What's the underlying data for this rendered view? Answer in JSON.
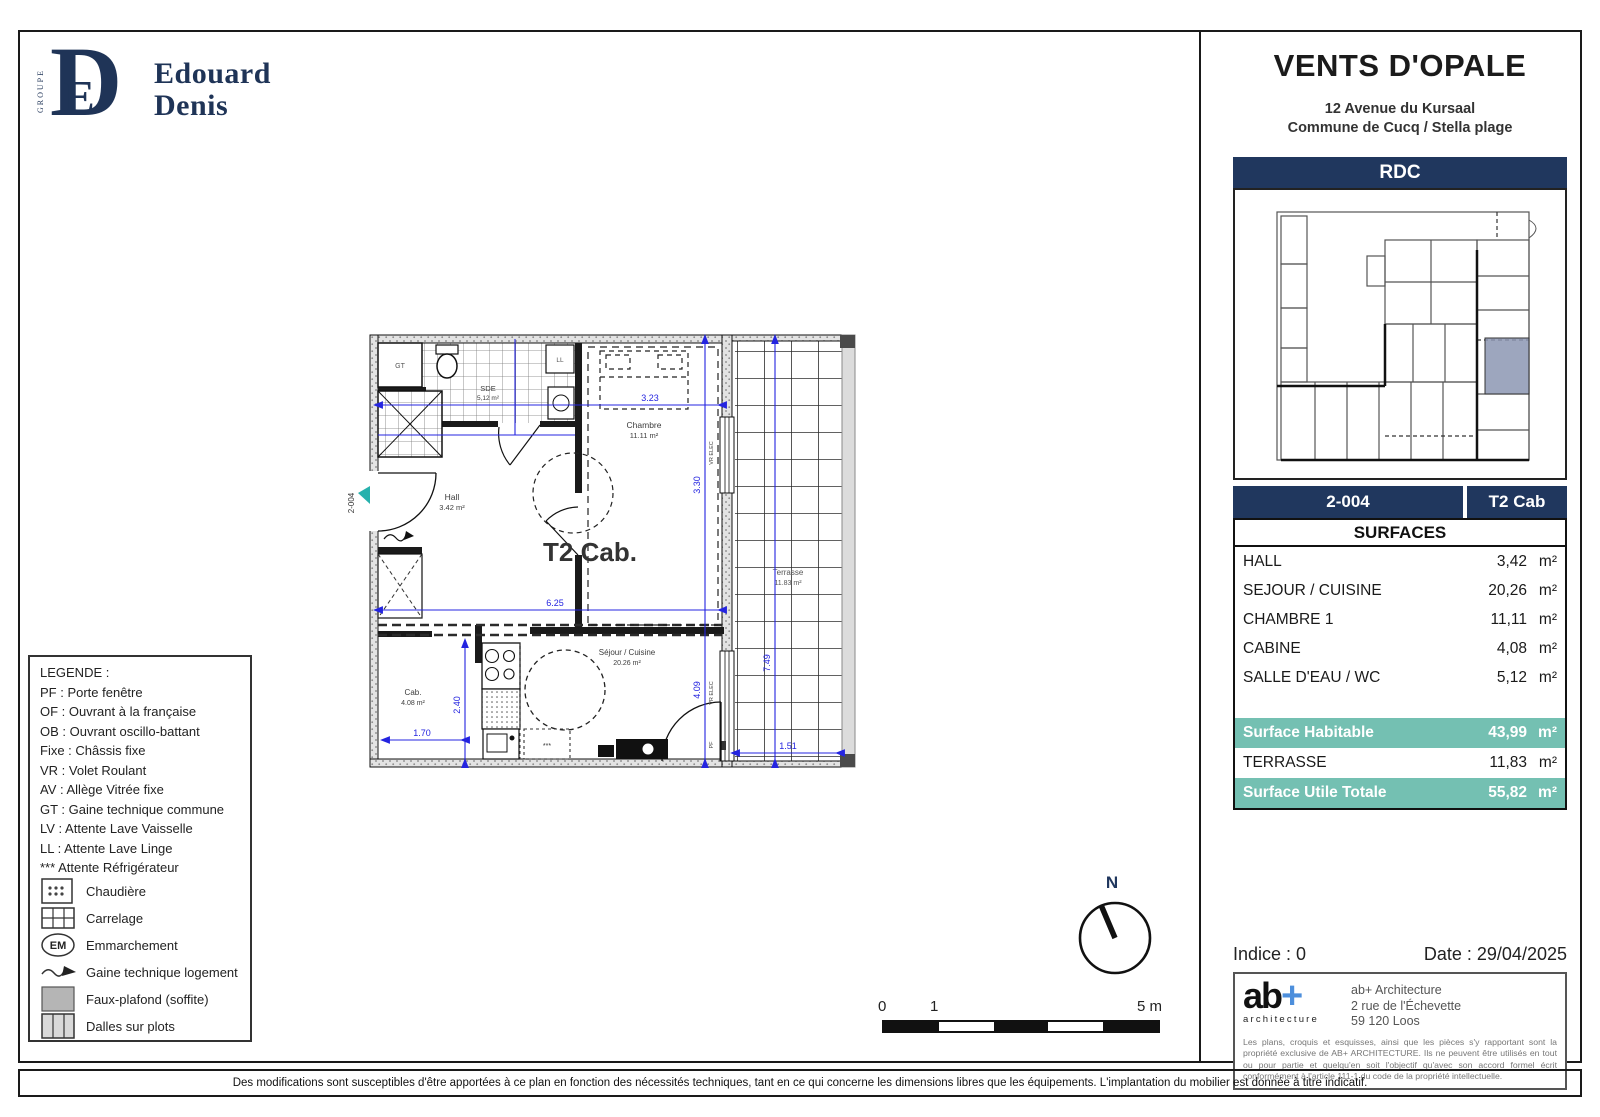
{
  "logo": {
    "groupe": "GROUPE",
    "monogram_d": "D",
    "monogram_e": "E",
    "name_line1": "Edouard",
    "name_line2": "Denis"
  },
  "header": {
    "title": "VENTS D'OPALE",
    "address_line1": "12 Avenue du Kursaal",
    "address_line2": "Commune de Cucq / Stella plage"
  },
  "panel": {
    "level_label": "RDC",
    "unit_number": "2-004",
    "unit_type": "T2 Cab",
    "surfaces_title": "SURFACES",
    "area_unit": "m²",
    "rooms": [
      {
        "label": "HALL",
        "value": "3,42"
      },
      {
        "label": "SEJOUR / CUISINE",
        "value": "20,26"
      },
      {
        "label": "CHAMBRE 1",
        "value": "11,11"
      },
      {
        "label": "CABINE",
        "value": "4,08"
      },
      {
        "label": "SALLE D'EAU / WC",
        "value": "5,12"
      }
    ],
    "totals": [
      {
        "label": "Surface Habitable",
        "value": "43,99"
      },
      {
        "label": "TERRASSE",
        "value": "11,83"
      },
      {
        "label": "Surface Utile Totale",
        "value": "55,82"
      }
    ],
    "indice_label": "Indice : 0",
    "date_label": "Date : 29/04/2025",
    "architect": {
      "logo_ab": "ab",
      "logo_plus": "+",
      "logo_sub": "architecture",
      "name": "ab+ Architecture",
      "street": "2 rue de l'Échevette",
      "city": "59 120 Loos",
      "disclaimer": "Les plans, croquis et esquisses, ainsi que les pièces s'y rapportant sont la propriété exclusive de AB+ ARCHITECTURE. Ils ne peuvent être utilisés en tout ou pour partie et quelqu'en soit l'objectif qu'avec son accord formel écrit conformément à l'article 111-1 du code de la propriété intellectuelle."
    }
  },
  "legend": {
    "title": "LEGENDE :",
    "entries": [
      "PF : Porte fenêtre",
      "OF : Ouvrant à la française",
      "OB : Ouvrant oscillo-battant",
      "Fixe : Châssis fixe",
      "VR : Volet Roulant",
      "AV : Allège Vitrée fixe",
      "GT : Gaine technique commune",
      "LV : Attente Lave Vaisselle",
      "LL : Attente Lave Linge",
      "*** Attente Réfrigérateur"
    ],
    "symbols": [
      {
        "label": "Chaudière"
      },
      {
        "label": "Carrelage"
      },
      {
        "label": "Emmarchement",
        "badge": "EM"
      },
      {
        "label": "Gaine technique logement"
      },
      {
        "label": "Faux-plafond (soffite)"
      },
      {
        "label": "Dalles sur plots"
      }
    ]
  },
  "plan": {
    "unit_label": "T2 Cab.",
    "entrance_tag": "2-004",
    "north_label": "N",
    "rooms": {
      "sde": {
        "name": "SDE",
        "area": "5,12 m²"
      },
      "chambre": {
        "name": "Chambre",
        "area": "11.11 m²"
      },
      "hall": {
        "name": "Hall",
        "area": "3.42 m²"
      },
      "cab": {
        "name": "Cab.",
        "area": "4.08 m²"
      },
      "sejour": {
        "name": "Séjour / Cuisine",
        "area": "20.26 m²"
      },
      "terrasse": {
        "name": "Terrasse",
        "area": "11.83 m²"
      }
    },
    "tags": {
      "gt": "GT",
      "ll": "LL",
      "vr1": "VR ELEC",
      "vr2": "VR ELEC",
      "pf": "PF",
      "fridge": "***"
    },
    "dims": {
      "d323": "3.23",
      "d330": "3.30",
      "d625": "6.25",
      "d409": "4.09",
      "d240": "2.40",
      "d170": "1.70",
      "d151": "1.51",
      "d749": "7.49"
    },
    "scale": {
      "n0": "0",
      "n1": "1",
      "n5": "5 m"
    }
  },
  "footer": {
    "text": "Des modifications sont susceptibles d'être apportées à ce plan en fonction des nécessités techniques, tant en ce qui concerne les dimensions libres que les équipements. L'implantation du mobilier est donnée à titre indicatif."
  }
}
